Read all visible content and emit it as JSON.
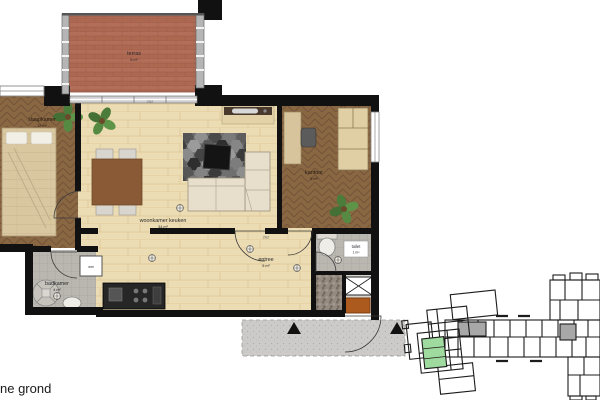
{
  "plan": {
    "floor_label": "ne grond",
    "rooms": [
      {
        "name": "terras",
        "area": "6 m²"
      },
      {
        "name": "slaapkamer",
        "area": "12 m²"
      },
      {
        "name": "woonkamer keuken",
        "area": "34 m²"
      },
      {
        "name": "kantoor",
        "area": "5 m²"
      },
      {
        "name": "badkamer",
        "area": "4 m²"
      },
      {
        "name": "entree",
        "area": "5 m²"
      },
      {
        "name": "toilet",
        "area": "1 m²"
      }
    ],
    "dimensions": {
      "top": "252",
      "entree": "262"
    },
    "fixtures": {
      "washer_label": "wm"
    }
  },
  "palette": {
    "wall": "#111111",
    "floor_light": "#ecddb5",
    "floor_dark": "#8a6743",
    "terrace_brick": "#b26e58",
    "tile_gray": "#bab7b1",
    "concrete": "#cccbc9",
    "mat_orange": "#ad5a1f",
    "plant_green": "#4c7c3c",
    "minimap_highlight": "#9fdb9f"
  }
}
